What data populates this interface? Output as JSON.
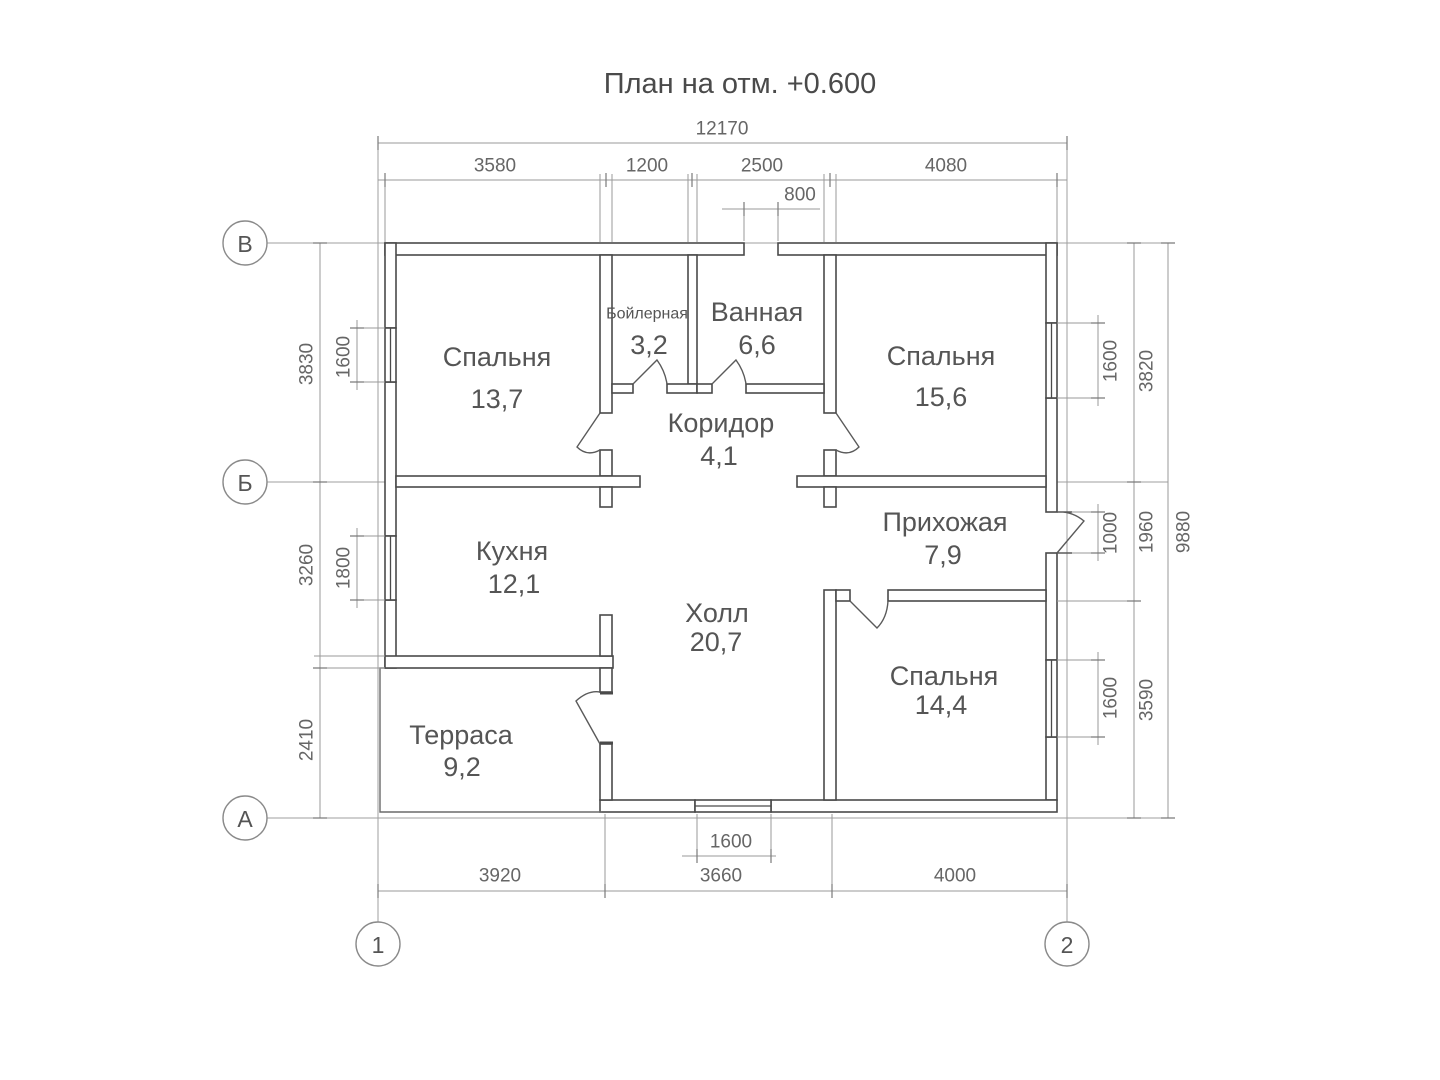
{
  "title": "План на отм. +0.600",
  "colors": {
    "wall": "#4a4a4a",
    "dim_line": "#9a9a9a",
    "text": "#555555",
    "dim_text": "#666666",
    "bg": "#ffffff"
  },
  "rooms": {
    "bedroom1": {
      "name": "Спальня",
      "area": "13,7"
    },
    "boiler": {
      "name": "Бойлерная",
      "area": "3,2"
    },
    "bath": {
      "name": "Ванная",
      "area": "6,6"
    },
    "bedroom2": {
      "name": "Спальня",
      "area": "15,6"
    },
    "corridor": {
      "name": "Коридор",
      "area": "4,1"
    },
    "kitchen": {
      "name": "Кухня",
      "area": "12,1"
    },
    "entry": {
      "name": "Прихожая",
      "area": "7,9"
    },
    "hall": {
      "name": "Холл",
      "area": "20,7"
    },
    "bedroom3": {
      "name": "Спальня",
      "area": "14,4"
    },
    "terrace": {
      "name": "Терраса",
      "area": "9,2"
    }
  },
  "dims": {
    "top_overall": "12170",
    "top1": "3580",
    "top2": "1200",
    "top3": "2500",
    "top4": "4080",
    "top_vent": "800",
    "bottom1": "3920",
    "bottom2": "3660",
    "bottom3": "4000",
    "bottom_win": "1600",
    "left1": "3830",
    "left2": "3260",
    "left3": "2410",
    "left_win1": "1600",
    "left_win2": "1800",
    "right1": "3820",
    "right2": "1960",
    "right3": "3590",
    "right_overall": "9880",
    "right_win1": "1600",
    "right_door": "1000",
    "right_win2": "1600"
  },
  "axes": {
    "row1": "В",
    "row2": "Б",
    "row3": "А",
    "col1": "1",
    "col2": "2"
  }
}
